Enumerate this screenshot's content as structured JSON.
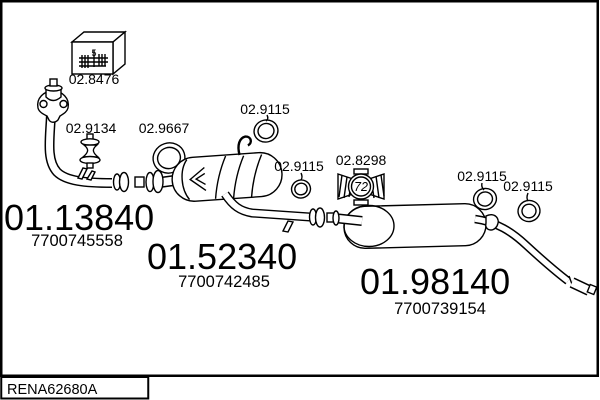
{
  "catalog": {
    "code": "RENA62680A"
  },
  "colors": {
    "line": "#000000",
    "background": "#ffffff"
  },
  "parts": {
    "fitting_kit": {
      "label": "02.8476",
      "marking": "5"
    },
    "rubber_mount": {
      "label": "02.9134"
    },
    "gasket_ring": {
      "label": "02.9667"
    },
    "sealing_ring_1": {
      "label": "02.9115"
    },
    "sealing_ring_2": {
      "label": "02.9115"
    },
    "sealing_ring_3": {
      "label": "02.9115"
    },
    "sealing_ring_4": {
      "label": "02.9115"
    },
    "clamp": {
      "label": "02.8298",
      "diameter_marking": "72"
    },
    "front_pipe": {
      "code": "01.13840",
      "oem_ref": "7700745558"
    },
    "centre_silencer": {
      "code": "01.52340",
      "oem_ref": "7700742485"
    },
    "rear_silencer": {
      "code": "01.98140",
      "oem_ref": "7700739154"
    }
  }
}
